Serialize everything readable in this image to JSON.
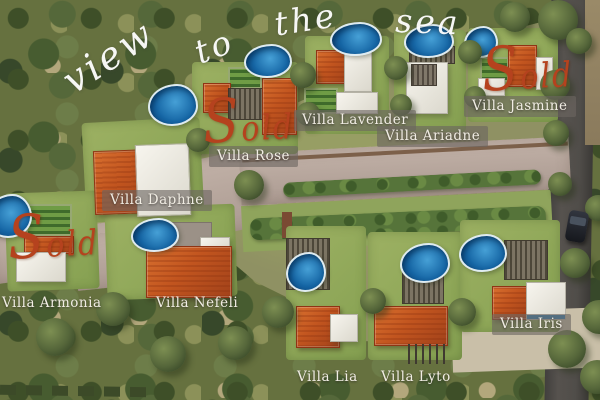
{
  "scene": {
    "description": "Aerial 3D render of a seaside villa development master plan",
    "watermark": {
      "color": "#ffffff",
      "words": [
        {
          "text": "view",
          "x": 56,
          "y": 68,
          "rotate": -33,
          "size": 38
        },
        {
          "text": "to",
          "x": 190,
          "y": 38,
          "rotate": -21,
          "size": 33
        },
        {
          "text": "the",
          "x": 272,
          "y": 8,
          "rotate": -9,
          "size": 33
        },
        {
          "text": "sea",
          "x": 396,
          "y": 4,
          "rotate": 2,
          "size": 33
        }
      ]
    },
    "sold": {
      "color": "#b5421e",
      "markers": [
        {
          "label": "Sold",
          "x": 203,
          "y": 100,
          "size": 30,
          "rotate": -3
        },
        {
          "label": "Sold",
          "x": 482,
          "y": 48,
          "size": 30,
          "rotate": -3
        },
        {
          "label": "Sold",
          "x": 8,
          "y": 216,
          "size": 30,
          "rotate": -3
        }
      ]
    },
    "villas": [
      {
        "name": "Villa Rose",
        "x": 209,
        "y": 146,
        "chip": true
      },
      {
        "name": "Villa Lavender",
        "x": 294,
        "y": 110,
        "chip": true
      },
      {
        "name": "Villa Ariadne",
        "x": 377,
        "y": 126,
        "chip": true
      },
      {
        "name": "Villa Jasmine",
        "x": 464,
        "y": 96,
        "chip": true
      },
      {
        "name": "Villa Daphne",
        "x": 102,
        "y": 190,
        "chip": true
      },
      {
        "name": "Villa Armonia",
        "x": 2,
        "y": 295,
        "chip": false
      },
      {
        "name": "Villa Nefeli",
        "x": 156,
        "y": 295,
        "chip": false
      },
      {
        "name": "Villa Lia",
        "x": 297,
        "y": 369,
        "chip": false
      },
      {
        "name": "Villa Lyto",
        "x": 381,
        "y": 369,
        "chip": false
      },
      {
        "name": "Villa Iris",
        "x": 492,
        "y": 314,
        "chip": true
      }
    ],
    "palette": {
      "pool": "#1f6fad",
      "roof": "#c2551f",
      "road": "#b8a89f",
      "asphalt": "#4b4847",
      "lawn": "#95aa5e",
      "forest": "#5f6e41",
      "chip_bg": "rgba(108,102,97,0.62)",
      "label_text": "#f1ede4"
    }
  }
}
